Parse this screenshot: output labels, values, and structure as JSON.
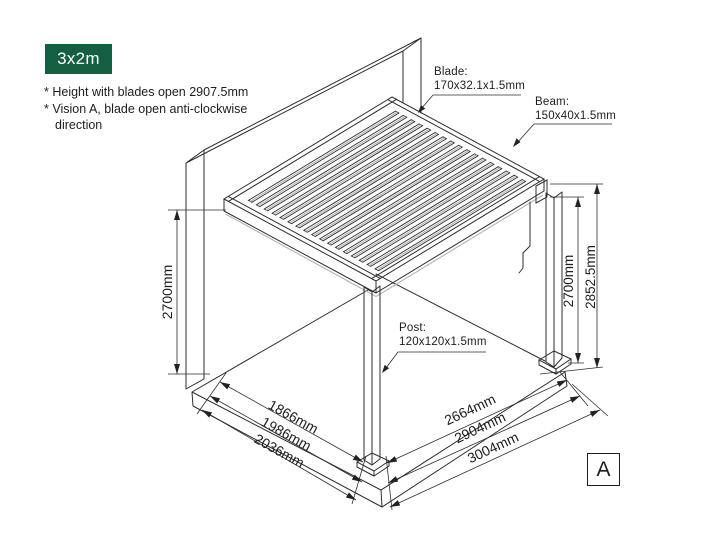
{
  "badge": {
    "label": "3x2m"
  },
  "notes": {
    "note1": "* Height with blades open 2907.5mm",
    "note2": "* Vision A, blade open anti-clockwise direction"
  },
  "part_labels": {
    "blade": {
      "name": "Blade:",
      "size": "170x32.1x1.5mm"
    },
    "beam": {
      "name": "Beam:",
      "size": "150x40x1.5mm"
    },
    "post": {
      "name": "Post:",
      "size": "120x120x1.5mm"
    }
  },
  "dimensions": {
    "wall_height": "2700mm",
    "post_height": "2700mm",
    "total_height": "2852.5mm",
    "depth_inner": "1866mm",
    "depth_mid": "1986mm",
    "depth_outer": "2036mm",
    "width_inner": "2664mm",
    "width_mid": "2904mm",
    "width_outer": "3004mm"
  },
  "vision_label": "A",
  "colors": {
    "badge_green": "#155F41",
    "line": "#2e2e2e",
    "text": "#1d1d1d"
  }
}
